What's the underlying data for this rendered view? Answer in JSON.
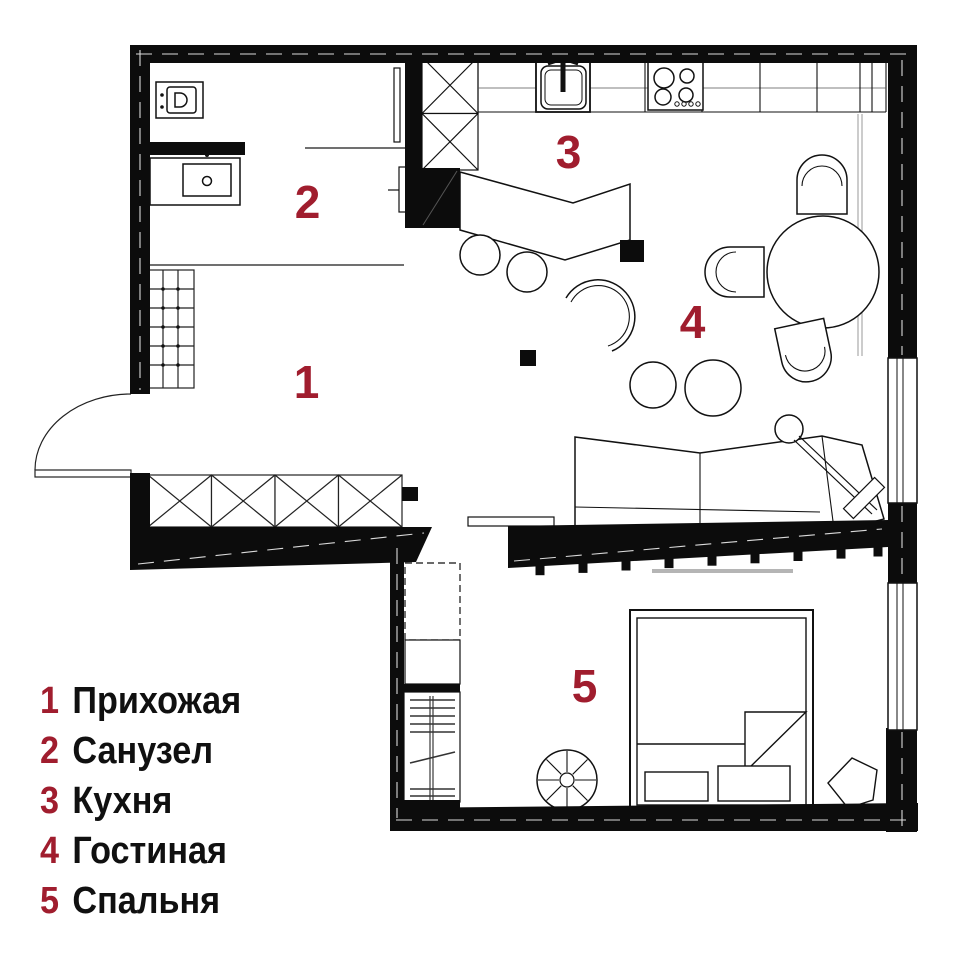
{
  "colors": {
    "accent": "#a01d2e",
    "wall": "#0c0c0c",
    "line": "#1a1a1a"
  },
  "legend": {
    "items": [
      {
        "num": "1",
        "label": "Прихожая"
      },
      {
        "num": "2",
        "label": "Санузел"
      },
      {
        "num": "3",
        "label": "Кухня"
      },
      {
        "num": "4",
        "label": "Гостиная"
      },
      {
        "num": "5",
        "label": "Спальня"
      }
    ]
  },
  "plan": {
    "room_labels": [
      {
        "num": "1",
        "name": "Прихожая"
      },
      {
        "num": "2",
        "name": "Санузел"
      },
      {
        "num": "3",
        "name": "Кухня"
      },
      {
        "num": "4",
        "name": "Гостиная"
      },
      {
        "num": "5",
        "name": "Спальня"
      }
    ]
  }
}
